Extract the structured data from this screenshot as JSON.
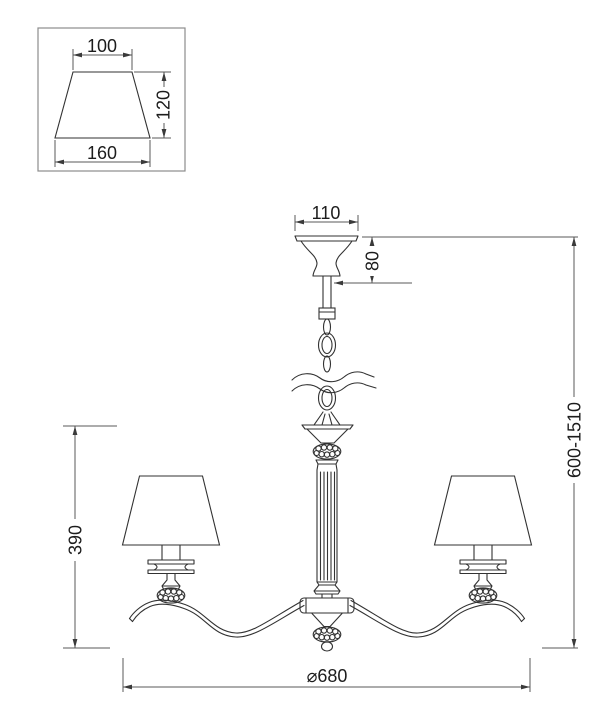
{
  "drawing": {
    "units_note": "dimension drawing values",
    "colors": {
      "background": "#ffffff",
      "object_lines": "#323232",
      "dimension_lines": "#5a5a5a",
      "text": "#1c1c1c",
      "inset_border": "#8c8c8c"
    },
    "shade_detail": {
      "top_width": "100",
      "height": "120",
      "bottom_width": "160"
    },
    "canopy": {
      "width": "110",
      "height": "80"
    },
    "main": {
      "overall_height": "600-1510",
      "body_height": "390",
      "diameter": "⌀680"
    }
  }
}
